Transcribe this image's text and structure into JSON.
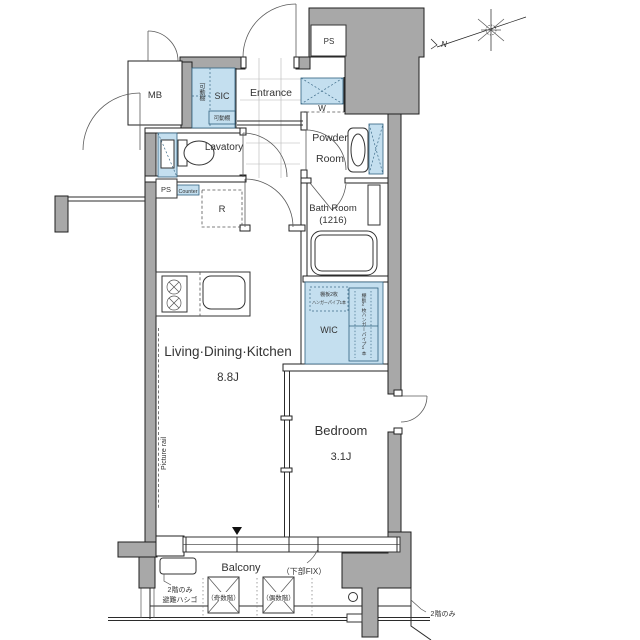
{
  "plan": {
    "title": "apartment-floor-plan",
    "compass": {
      "north_label": "N"
    },
    "rooms": {
      "mb": "MB",
      "ps_top": "PS",
      "ps_left": "PS",
      "sic": "SIC",
      "sic_shelf_vertical": "可動棚",
      "sic_shelf_small": "可動棚",
      "entrance": "Entrance",
      "washer": "W",
      "powder_line1": "Powder",
      "powder_line2": "Room",
      "lavatory": "Lavatory",
      "counter": "Counter",
      "bath_line1": "Bath Room",
      "bath_line2": "(1216)",
      "fridge": "R",
      "wic": "WIC",
      "wic_note_line1": "棚板2枚",
      "wic_note_line2": "ハンガーパイプ1本",
      "wic_note_vertical": "棚板2枚ハンガーパイプ1本",
      "ldk": "Living·Dining·Kitchen",
      "ldk_size": "8.8J",
      "bedroom": "Bedroom",
      "bedroom_size": "3.1J",
      "picture_rail": "Picture rail",
      "balcony": "Balcony",
      "fix_note": "（下部FIX）",
      "hatch_line1": "2階のみ",
      "hatch_line2": "避難ハシゴ",
      "odd_floor": "（奇数階）",
      "even_floor": "（偶数階）",
      "second_floor_note": "2階のみ"
    },
    "colors": {
      "wall_gray": "#a8a8a8",
      "fixture_blue": "#c4dfef",
      "line": "#2b2b2b"
    }
  }
}
